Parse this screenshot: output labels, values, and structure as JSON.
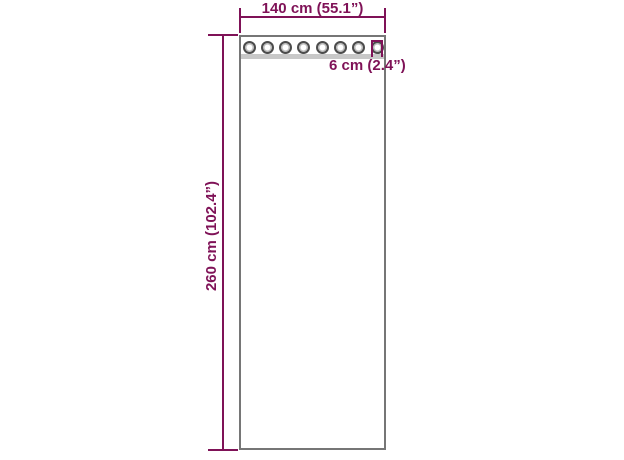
{
  "diagram": {
    "subject": "curtain-panel-with-grommets",
    "labels": {
      "width": "140 cm (55.1”)",
      "height": "260 cm (102.4”)",
      "grommet": "6 cm (2.4”)"
    },
    "grommets": {
      "count": 8
    },
    "colors": {
      "dimension": "#7f1257",
      "panel_border": "#767676",
      "header_strip": "#c8c8c8",
      "grommet_ring": "#4c4c4c",
      "background": "#ffffff"
    }
  }
}
